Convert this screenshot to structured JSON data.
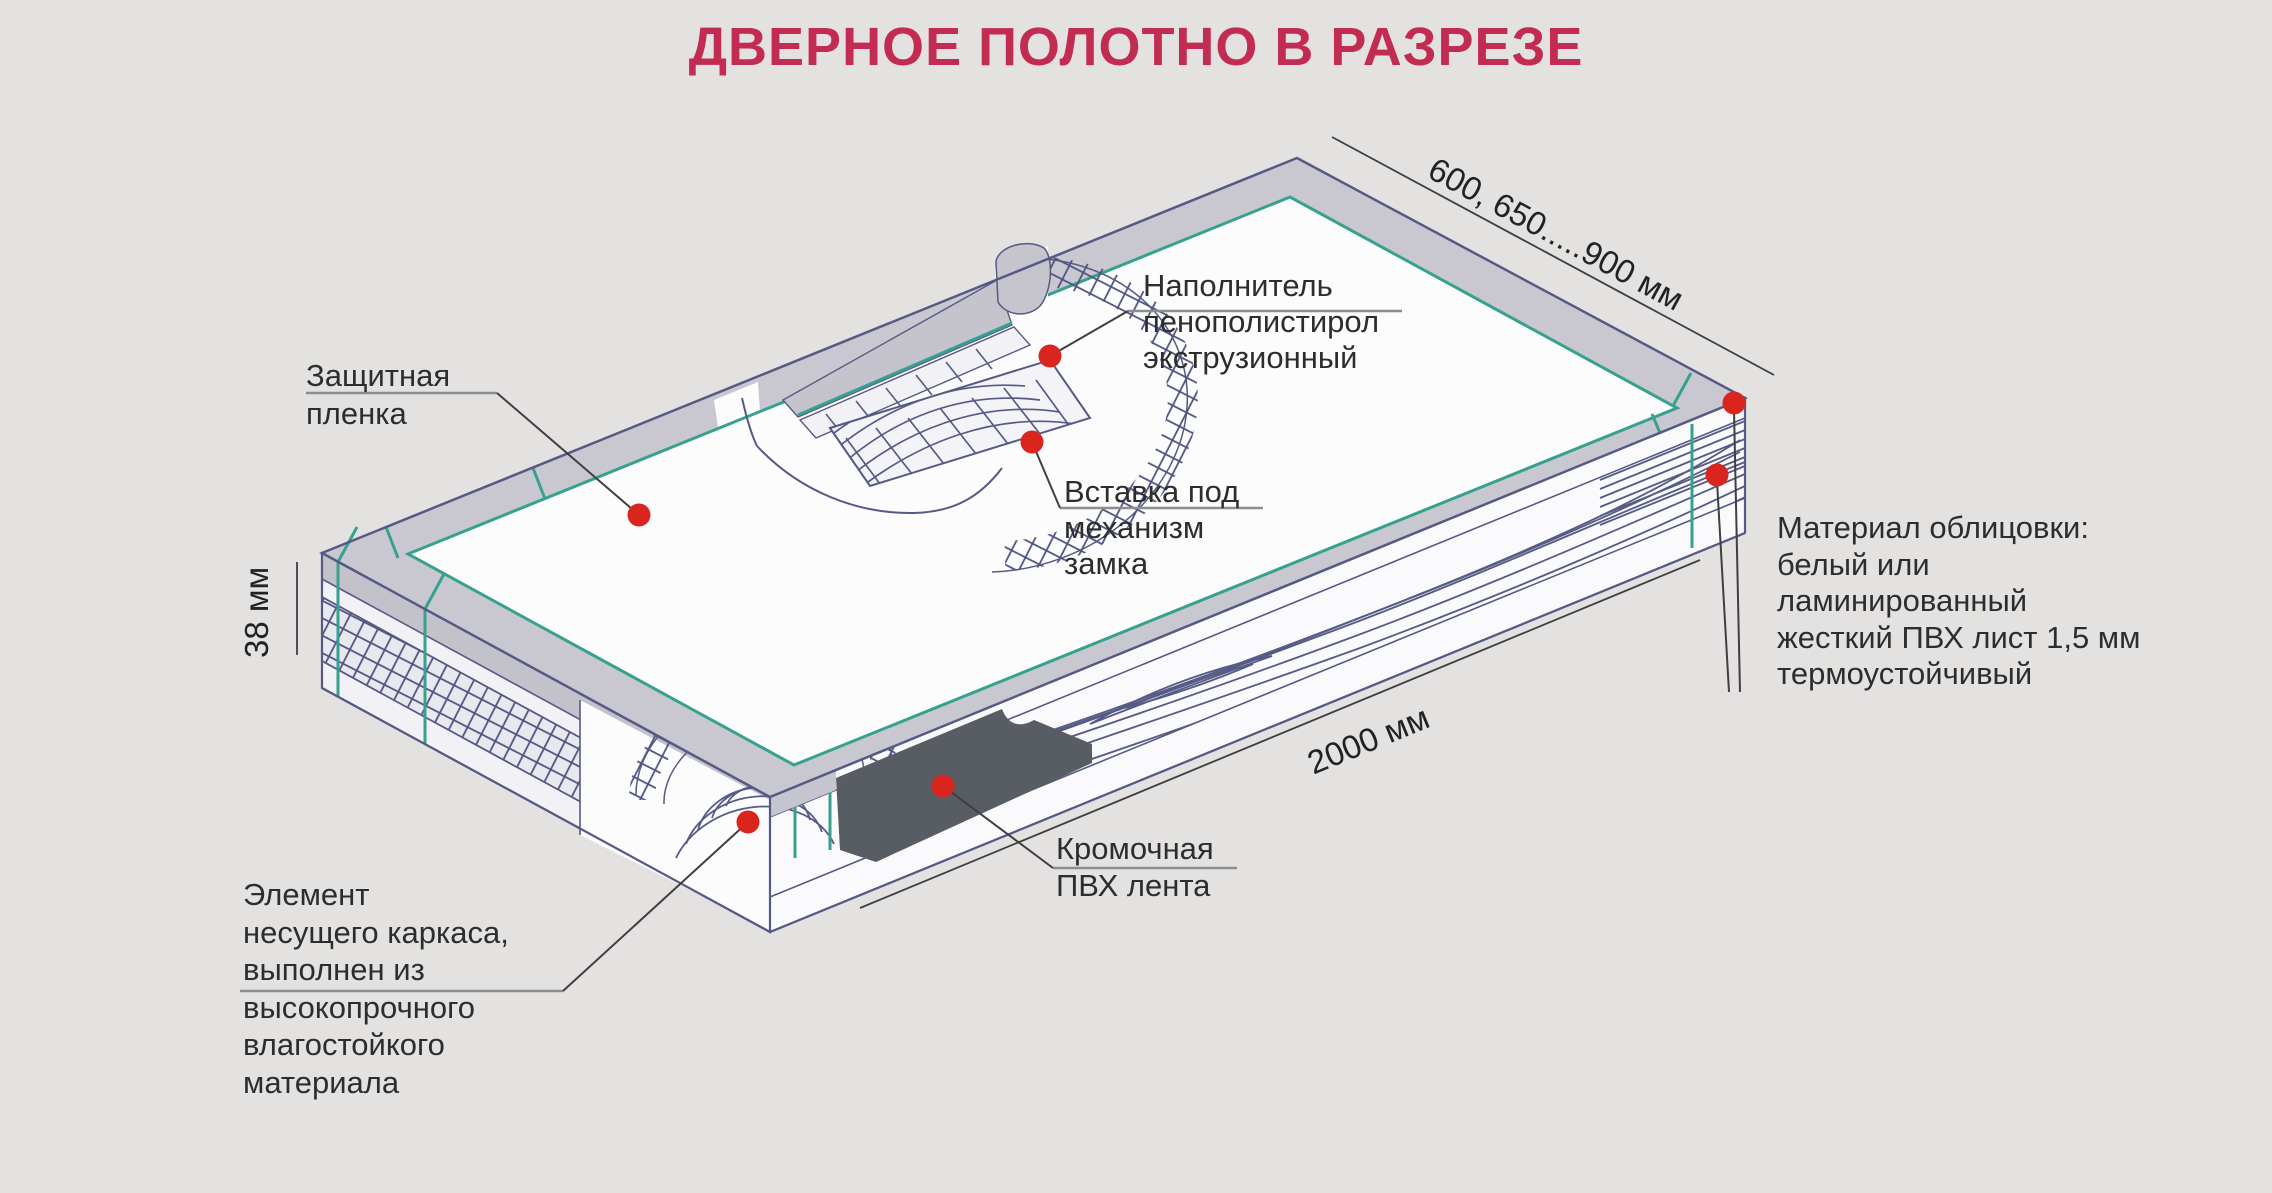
{
  "title": "ДВЕРНОЕ ПОЛОТНО В РАЗРЕЗЕ",
  "labels": {
    "protective_film": "Защитная\nпленка",
    "filler": "Наполнитель\nпенополистирол\nэкструзионный",
    "lock_insert": "Вставка под\nмеханизм\nзамка",
    "facing_material": "Материал облицовки:\nбелый или\nламинированный\nжесткий ПВХ лист 1,5 мм\nтермоустойчивый",
    "edge_tape": "Кромочная\nПВХ лента",
    "frame_element": "Элемент\nнесущего каркаса,\nвыполнен из\nвысокопрочного\nвлагостойкого\nматериала"
  },
  "dimensions": {
    "door_width": "600, 650.....900 мм",
    "door_thickness": "38 мм",
    "door_length": "2000 мм"
  },
  "colors": {
    "background": "#e3e2e1",
    "title": "#c22b52",
    "marker_red": "#da251f",
    "teal_accent": "#37a18f",
    "line_slate": "#555a85",
    "panel_gray": "#c9c8d0",
    "panel_white": "#fcfcfd",
    "edge_tape_dark": "#585d63"
  }
}
